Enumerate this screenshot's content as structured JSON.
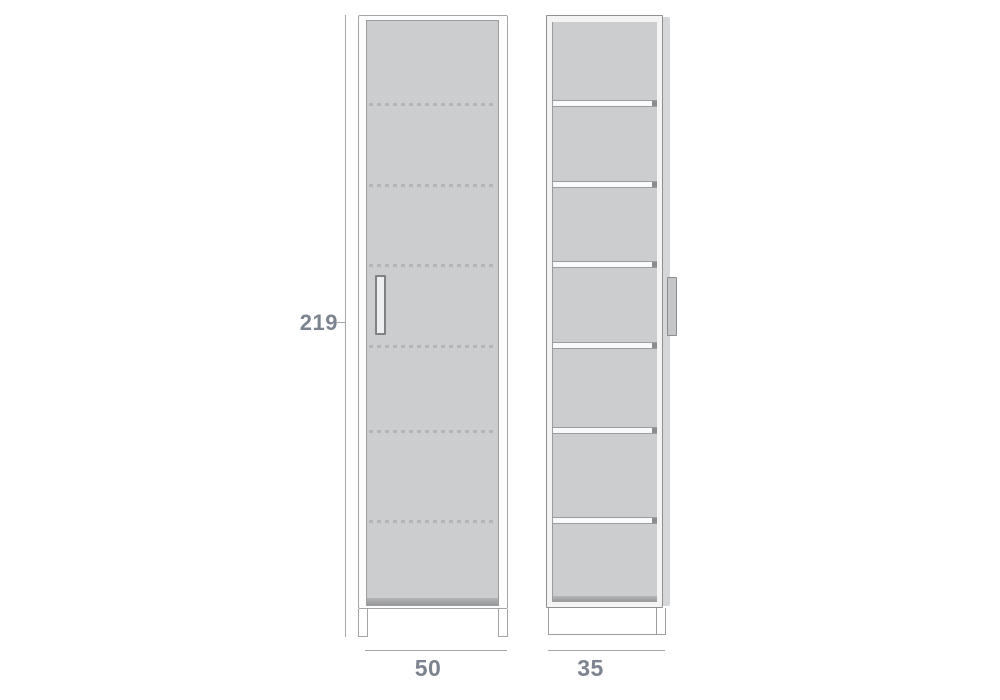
{
  "dimensions": {
    "height_label": "219",
    "width_label": "50",
    "depth_label": "35"
  },
  "front_view": {
    "description_name": "cabinet-front-elevation-closed-door",
    "dashed_line_tops_px": [
      82,
      163,
      243,
      324,
      409,
      499
    ],
    "has_door_handle": true
  },
  "side_view": {
    "description_name": "cabinet-side-section-with-shelves",
    "compartment_count": 7,
    "shelf_gap_tops_px": [
      78,
      159,
      239,
      320,
      405,
      495
    ],
    "has_door_handle": true
  },
  "colors": {
    "background": "#ffffff",
    "panel_fill": "#cbcdce",
    "panel_edge": "#9a9c9d",
    "frame_line": "#a2a4a5",
    "dark_line": "#8e9091",
    "dashed_shelf": "#b4b5b6",
    "bottom_shade": "#98999b",
    "side_strip": "#d6d7d8",
    "handle_fill": "#eeeff0",
    "handle_border": "#7f8183",
    "dim_line": "#a3a8ad",
    "dim_text": "#7c8490"
  }
}
